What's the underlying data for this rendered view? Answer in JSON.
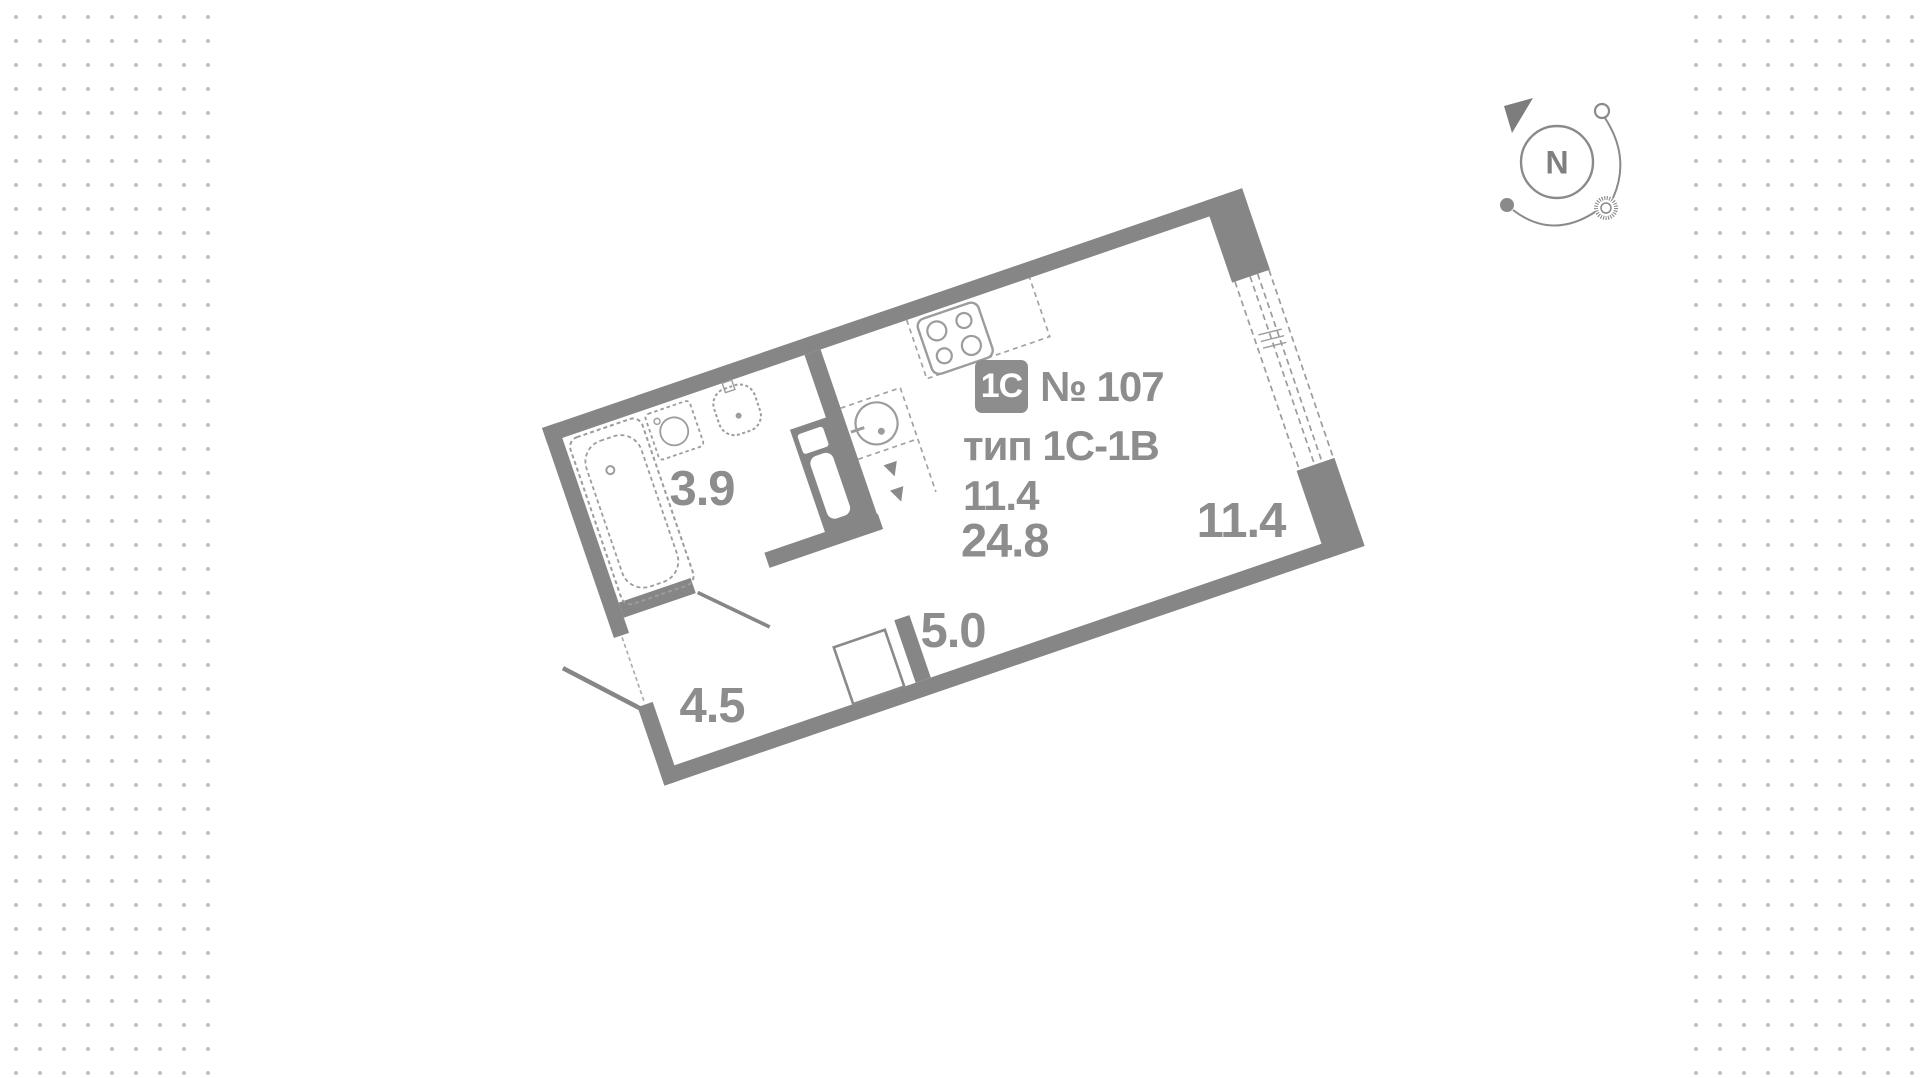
{
  "unit_info": {
    "badge": "1C",
    "number": "№ 107",
    "type_line": "тип 1С-1В",
    "living_area": "11.4",
    "total_area": "24.8"
  },
  "rooms": [
    {
      "id": "bathroom",
      "area": "3.9"
    },
    {
      "id": "hallway",
      "area": "4.5"
    },
    {
      "id": "kitchen",
      "area": "5.0"
    },
    {
      "id": "living-room",
      "area": "11.4"
    }
  ],
  "compass": {
    "label": "N"
  },
  "colors": {
    "wall": "#868686",
    "fixture": "#9c9c9c",
    "label_text": "#8d8d8d",
    "dots": "#c0c0c0",
    "panel": "#ffffff"
  }
}
